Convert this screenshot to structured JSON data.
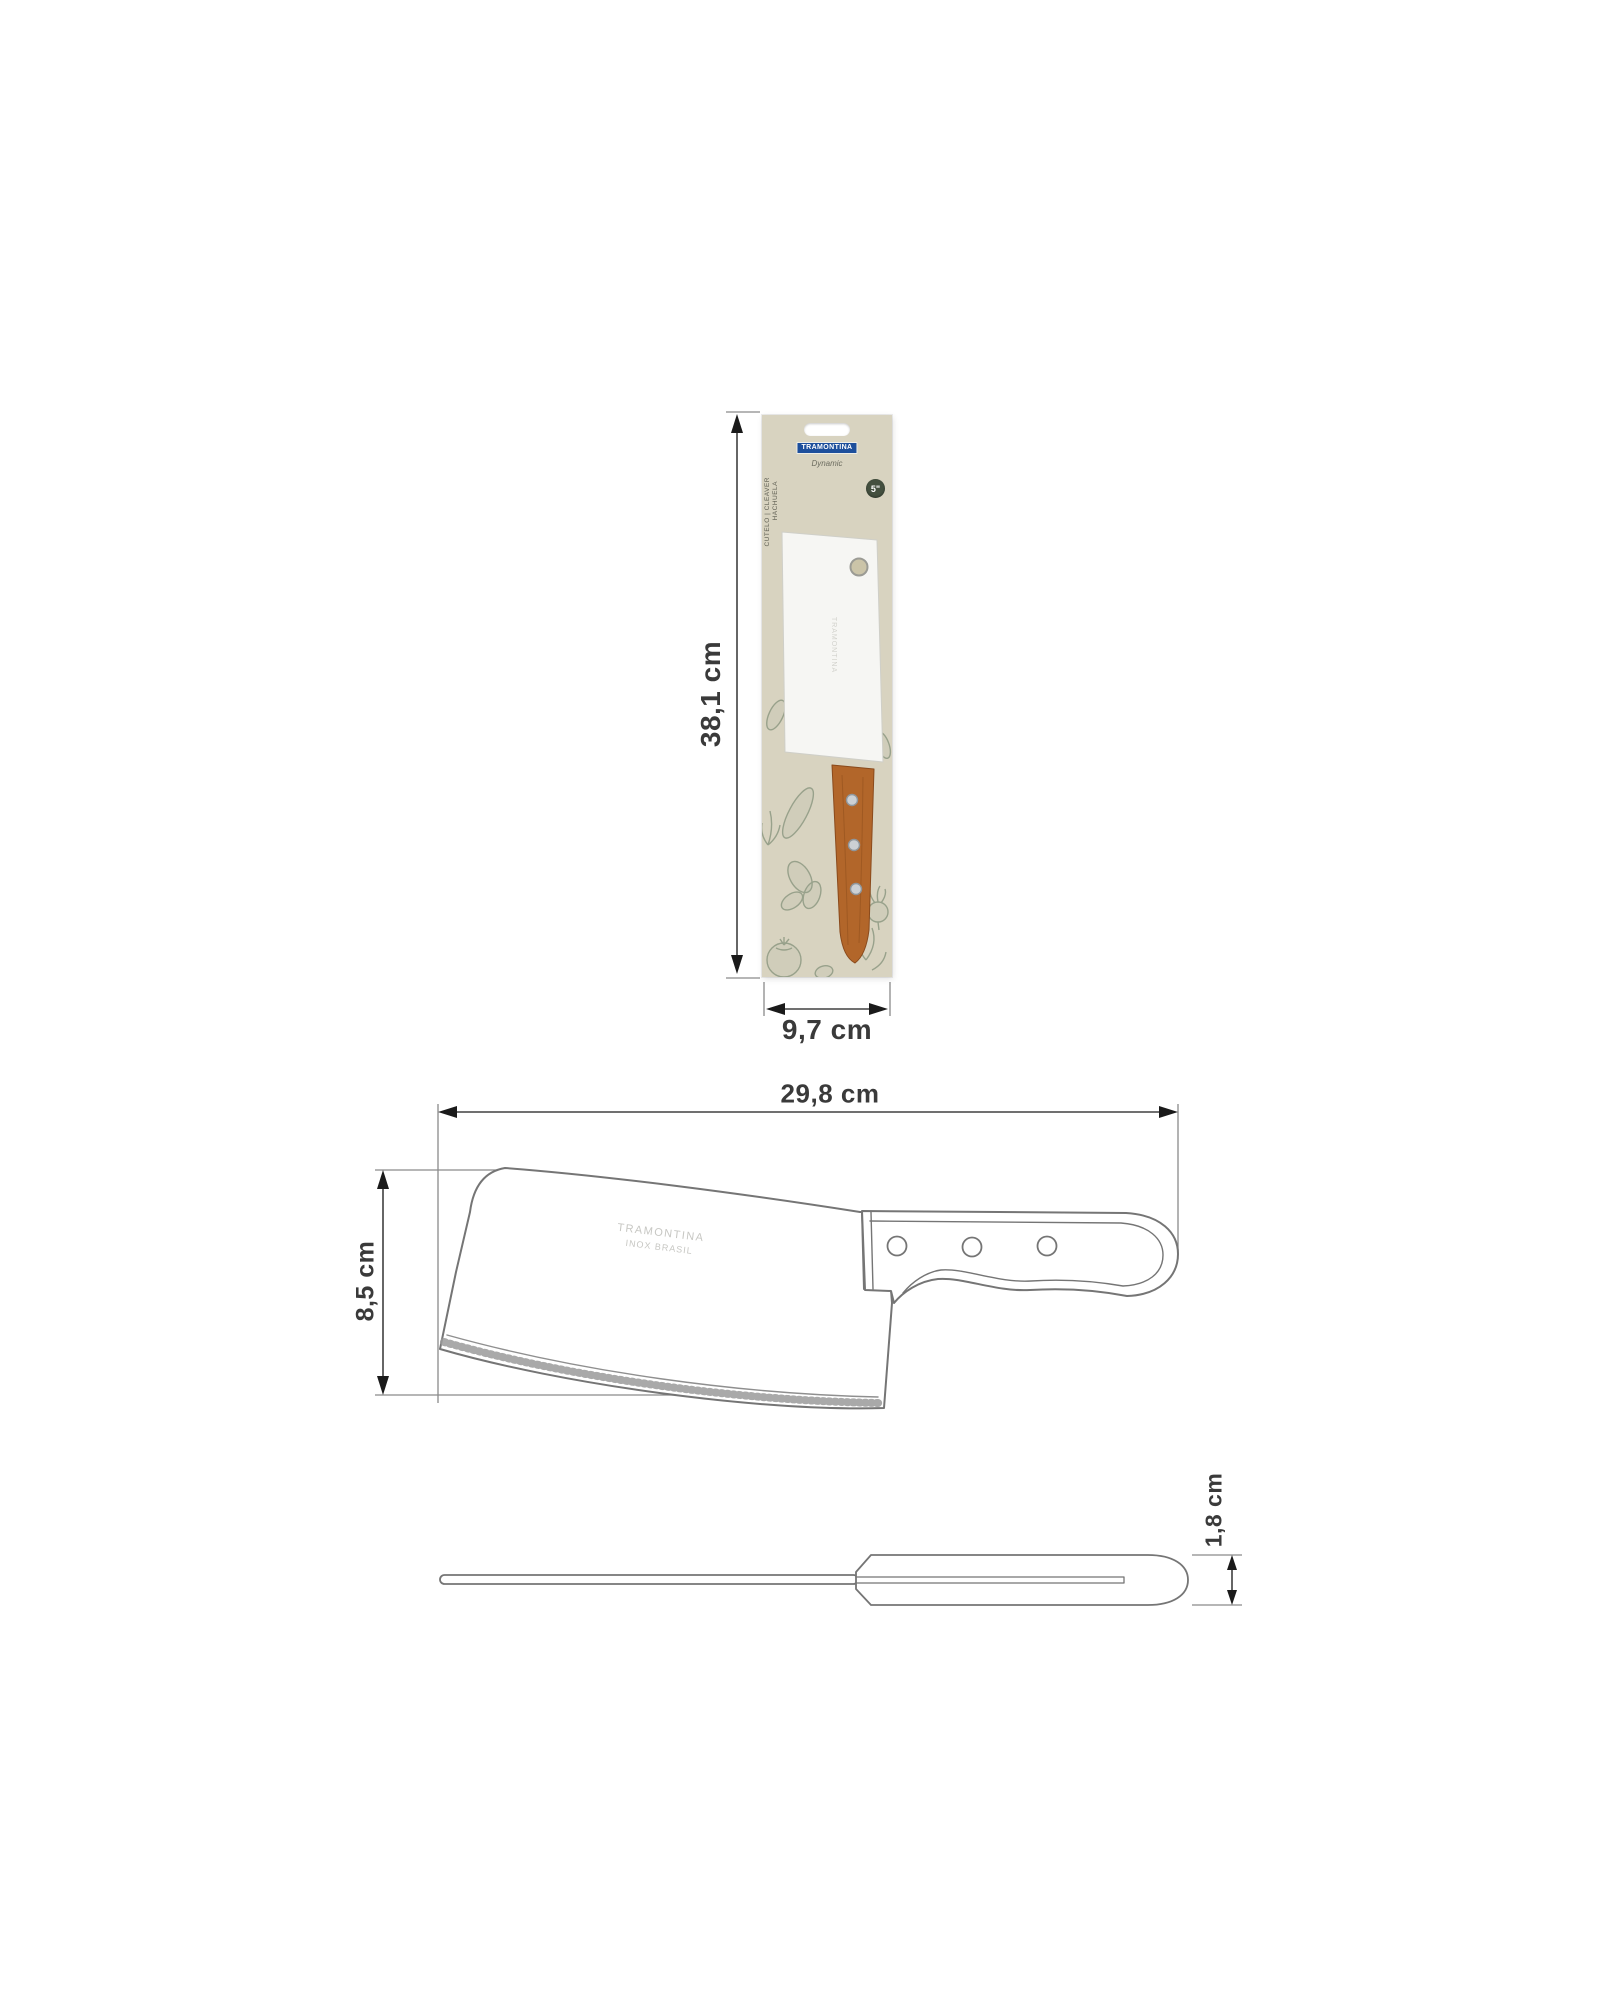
{
  "package": {
    "brand": "TRAMONTINA",
    "line": "Dynamic",
    "category_line1": "CUTELO | CLEAVER",
    "category_line2": "HACHUELA",
    "size_badge": "5\"",
    "blade_etch": "TRAMONTINA",
    "height_label": "38,1 cm",
    "width_label": "9,7 cm"
  },
  "side_view": {
    "length_label": "29,8 cm",
    "height_label": "8,5 cm",
    "etch_line1": "TRAMONTINA",
    "etch_line2": "INOX BRASIL"
  },
  "top_view": {
    "thickness_label": "1,8 cm"
  },
  "colors": {
    "brand_blue": "#1d4f9c",
    "card_beige": "#d8d3c0",
    "wood": "#b2662a",
    "foliage_green": "#6e8068",
    "badge_green": "#44503f",
    "dimension_line": "#404040",
    "drawing_outline": "#757575"
  }
}
